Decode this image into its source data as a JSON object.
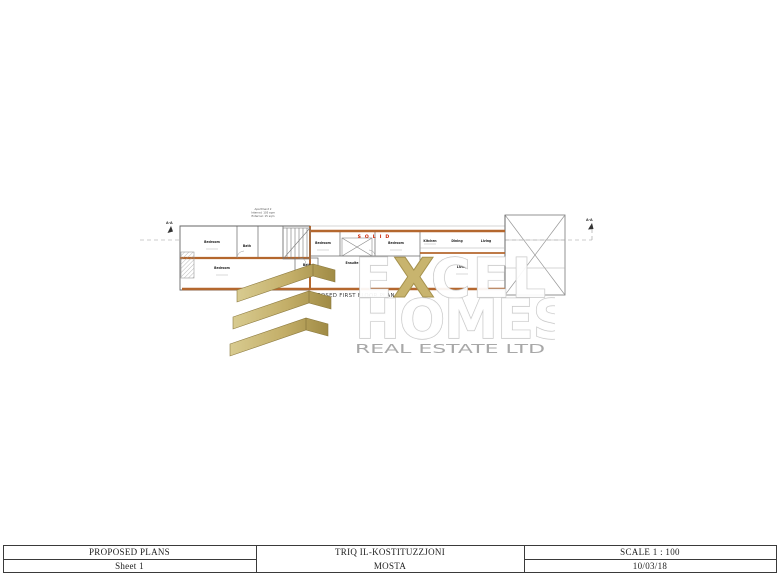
{
  "title_block": {
    "left": {
      "title": "PROPOSED PLANS",
      "subtitle": "Sheet 1"
    },
    "center": {
      "title": "TRIQ IL-KOSTITUZZJONI",
      "subtitle": "MOSTA"
    },
    "right": {
      "title": "SCALE 1 : 100",
      "subtitle": "10/03/18"
    }
  },
  "plan": {
    "caption": "PROPOSED FIRST FLOOR PLAN",
    "caption_scale": "1:100",
    "annotation_lines": [
      "Apartment 2",
      "Internal: 105 sqm",
      "External: 15 sqm"
    ],
    "solid_label": "S O L I D",
    "section_label_left": "A-A",
    "section_label_right": "A-A",
    "room_labels": [
      "Bedroom",
      "Bath",
      "Bedroom",
      "Bath",
      "Bedroom",
      "Bedroom",
      "Ensuite",
      "Kitchen",
      "Dining",
      "Living",
      "Living"
    ]
  },
  "watermark": {
    "brand_top_e": "E",
    "brand_top_x": "X",
    "brand_top_cel": "CEL",
    "brand_middle": "HOMES",
    "brand_bottom": "REAL ESTATE LTD"
  },
  "colors": {
    "gold": "#c9b878",
    "letter_outline": "#c8c8c8",
    "gray_brand_text": "#a8a8a8",
    "wall_orange": "#b4672e",
    "solid_red": "#cc2200"
  }
}
